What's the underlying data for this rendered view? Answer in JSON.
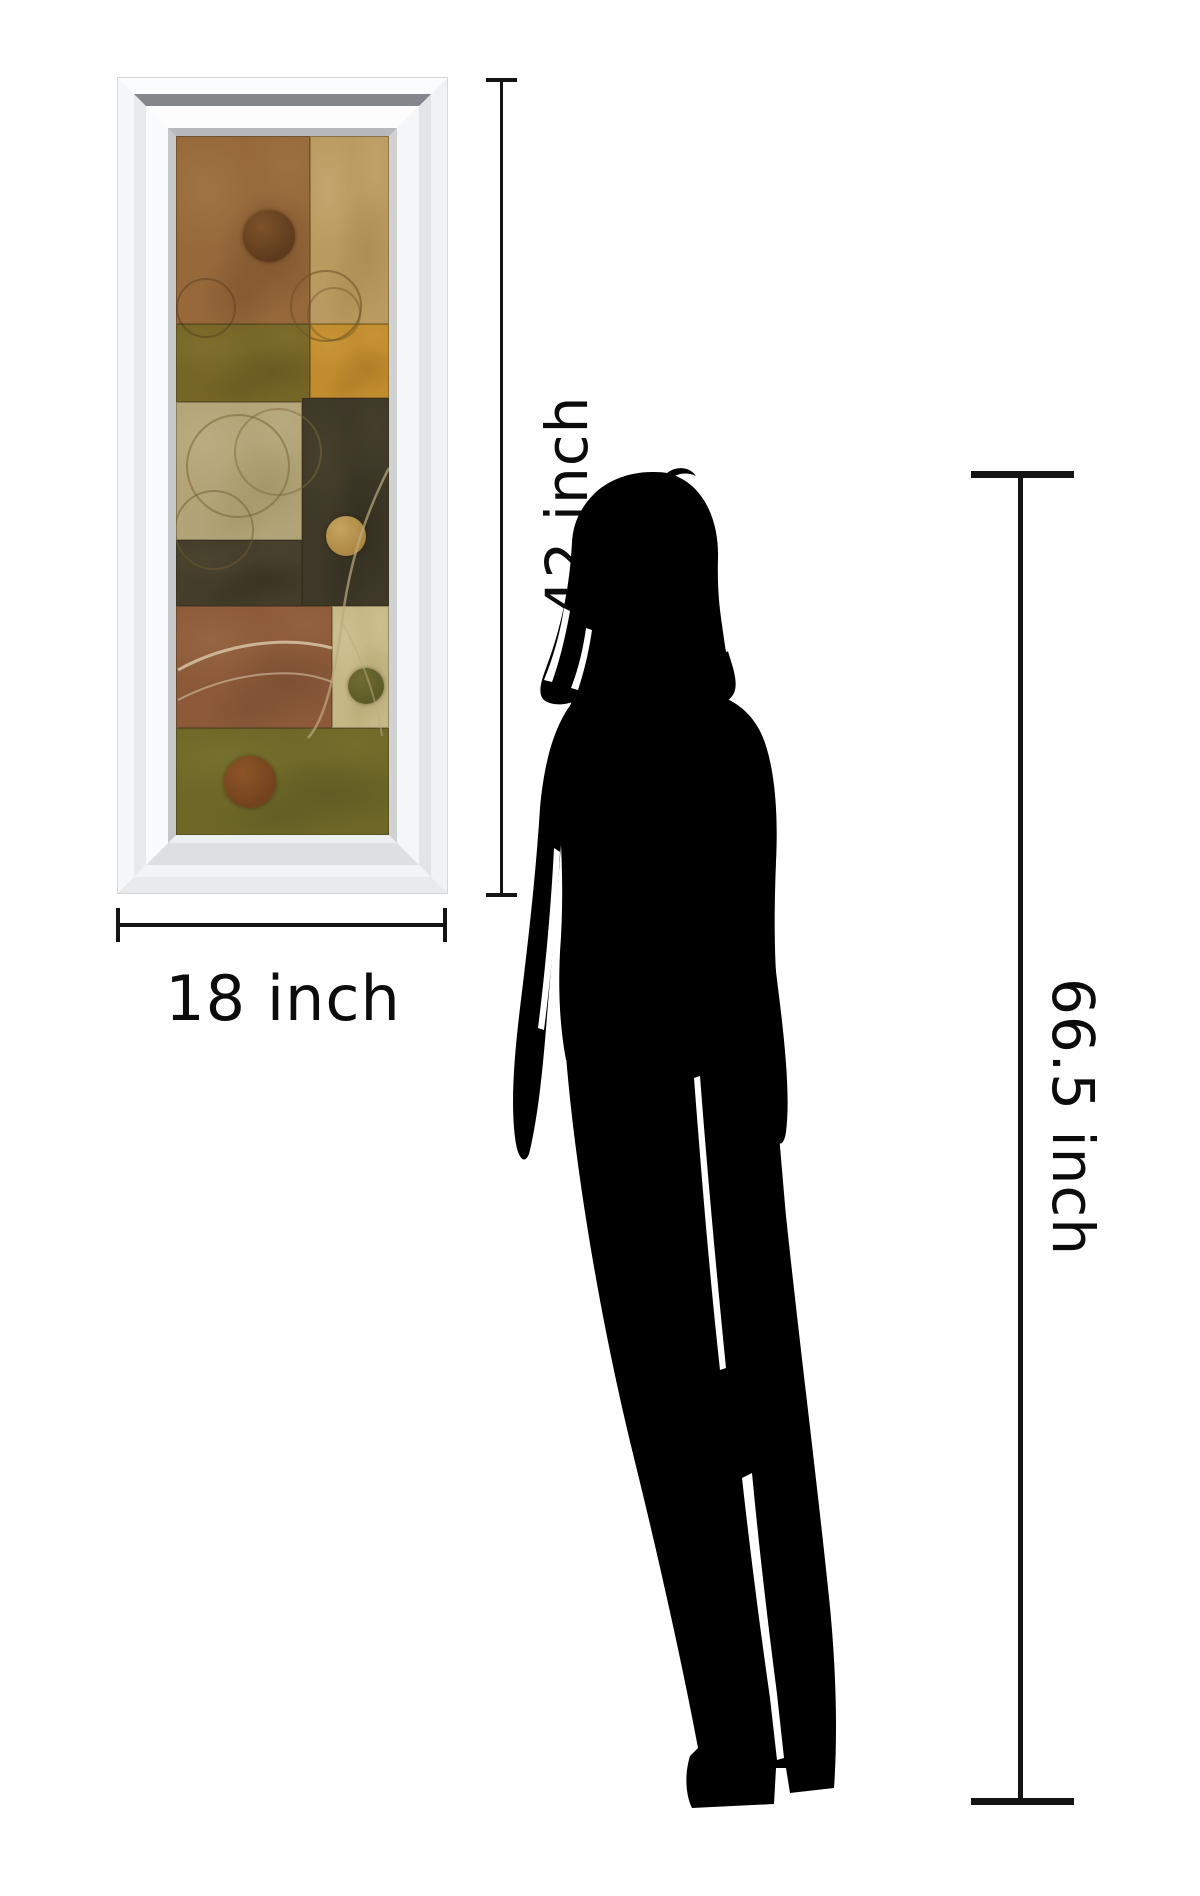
{
  "page": {
    "background": "#ffffff"
  },
  "artwork": {
    "name": "mirror framed abstract wall art",
    "frame_color": "#f4f5f6",
    "palette": {
      "brown": "#96683a",
      "tan": "#b99a60",
      "olive": "#756627",
      "amber": "#c08c2e",
      "beige": "#b2a478",
      "charcoal": "#3d3827",
      "copper": "#8c5a3a",
      "cream": "#c6b886",
      "moss": "#6e6728"
    },
    "blocks": [
      {
        "x": 0,
        "y": 0,
        "w": 134,
        "h": 188,
        "base": "#96683a",
        "dark": "#5f3d20",
        "light": "#b08a52"
      },
      {
        "x": 134,
        "y": 0,
        "w": 79,
        "h": 188,
        "base": "#b99a60",
        "dark": "#9a7c42",
        "light": "#d3bc88"
      },
      {
        "x": 0,
        "y": 188,
        "w": 134,
        "h": 78,
        "base": "#756627",
        "dark": "#55491a",
        "light": "#8f7f38"
      },
      {
        "x": 134,
        "y": 188,
        "w": 79,
        "h": 74,
        "base": "#c08c2e",
        "dark": "#95681c",
        "light": "#d8a847"
      },
      {
        "x": 0,
        "y": 266,
        "w": 126,
        "h": 138,
        "base": "#b2a478",
        "dark": "#938455",
        "light": "#c9bd92"
      },
      {
        "x": 126,
        "y": 262,
        "w": 87,
        "h": 208,
        "base": "#3d3827",
        "dark": "#272316",
        "light": "#565039"
      },
      {
        "x": 0,
        "y": 404,
        "w": 126,
        "h": 66,
        "base": "#433d2a",
        "dark": "#2b2718",
        "light": "#5a5339"
      },
      {
        "x": 0,
        "y": 470,
        "w": 156,
        "h": 122,
        "base": "#8c5a3a",
        "dark": "#68402a",
        "light": "#a87a50"
      },
      {
        "x": 156,
        "y": 470,
        "w": 57,
        "h": 122,
        "base": "#c6b886",
        "dark": "#a3935e",
        "light": "#dcd1a4"
      },
      {
        "x": 0,
        "y": 592,
        "w": 213,
        "h": 107,
        "base": "#6e6728",
        "dark": "#4f4a1c",
        "light": "#87803a"
      }
    ],
    "circles": [
      {
        "cx": 93,
        "cy": 100,
        "r": 26,
        "fill": "#5e3b1d",
        "hl": "#7c5329"
      },
      {
        "cx": 170,
        "cy": 400,
        "r": 20,
        "fill": "#ab8743",
        "hl": "#c6a55e"
      },
      {
        "cx": 190,
        "cy": 550,
        "r": 18,
        "fill": "#5d5b26",
        "hl": "#6f6d34"
      },
      {
        "cx": 74,
        "cy": 646,
        "r": 26,
        "fill": "#73421e",
        "hl": "#8c5527"
      }
    ],
    "rings": [
      {
        "cx": 150,
        "cy": 170,
        "r": 36,
        "stroke": "rgba(105,80,35,0.55)"
      },
      {
        "cx": 158,
        "cy": 178,
        "r": 27,
        "stroke": "rgba(105,80,35,0.40)"
      },
      {
        "cx": 30,
        "cy": 172,
        "r": 30,
        "stroke": "rgba(70,45,20,0.35)"
      },
      {
        "cx": 62,
        "cy": 330,
        "r": 52,
        "stroke": "rgba(125,105,60,0.60)"
      },
      {
        "cx": 102,
        "cy": 316,
        "r": 44,
        "stroke": "rgba(125,105,60,0.50)"
      },
      {
        "cx": 38,
        "cy": 394,
        "r": 40,
        "stroke": "rgba(110,92,50,0.50)"
      }
    ],
    "arcs": [
      {
        "d": "M213,332 C186,384 172,436 166,486 C158,546 148,584 132,602",
        "color": "rgba(190,170,130,0.70)",
        "w": 2.5
      },
      {
        "d": "M166,486 C186,522 200,560 206,600",
        "color": "rgba(190,170,130,0.50)",
        "w": 2
      },
      {
        "d": "M2,534 C52,506 112,500 156,512",
        "color": "rgba(215,195,165,0.85)",
        "w": 3
      },
      {
        "d": "M2,564 C56,536 118,530 156,546",
        "color": "rgba(200,180,150,0.70)",
        "w": 2
      }
    ]
  },
  "figure": {
    "name": "woman silhouette",
    "color": "#000000"
  },
  "dimensions": {
    "art_height": {
      "label": "42 inch"
    },
    "art_width": {
      "label": "18 inch"
    },
    "figure_height": {
      "label": "66.5 inch"
    },
    "line_color": "#141414"
  }
}
